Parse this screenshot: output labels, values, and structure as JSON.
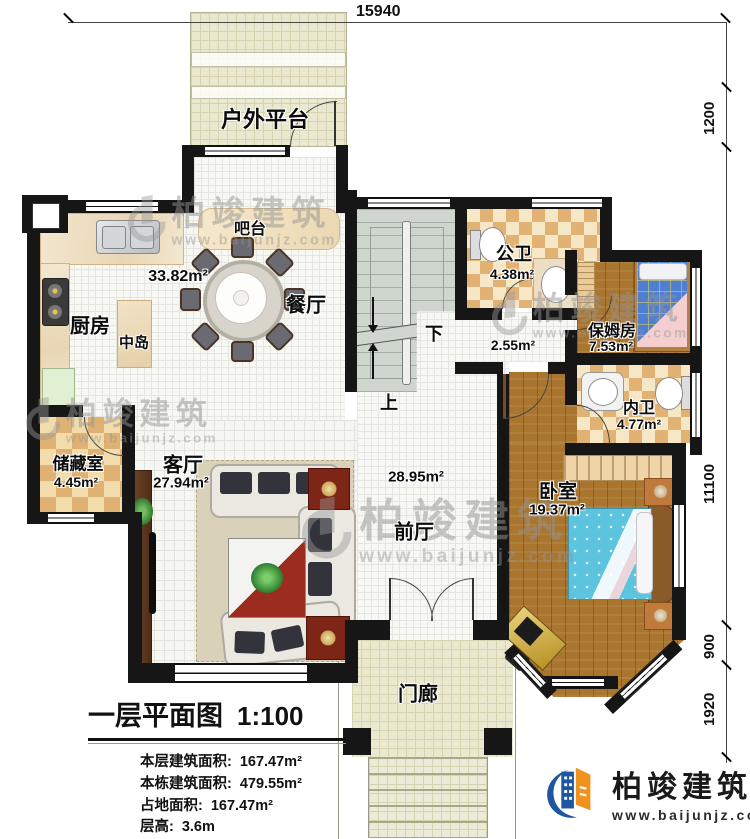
{
  "dimensions": {
    "top": "15940",
    "right": {
      "r1": "1200",
      "r2": "11100",
      "r3": "900",
      "r4": "1920"
    }
  },
  "rooms": {
    "platform": {
      "name": "户外平台"
    },
    "bar": {
      "name": "吧台"
    },
    "dining": {
      "name": "餐厅"
    },
    "dining_area": "33.82m²",
    "kitchen": {
      "name": "厨房"
    },
    "island": {
      "name": "中岛"
    },
    "public_bath": {
      "name": "公卫",
      "area": "4.38m²"
    },
    "nanny_room": {
      "name": "保姆房",
      "area": "7.53m²"
    },
    "inner_bath": {
      "name": "内卫",
      "area": "4.77m²"
    },
    "storage": {
      "name": "储藏室",
      "area": "4.45m²"
    },
    "living": {
      "name": "客厅",
      "area": "27.94m²"
    },
    "foyer": {
      "name": "前厅",
      "area": "28.95m²"
    },
    "corridor_area": "2.55m²",
    "bedroom": {
      "name": "卧室",
      "area": "19.37m²"
    },
    "porch": {
      "name": "门廊"
    }
  },
  "stairs": {
    "down": "下",
    "up": "上"
  },
  "title_block": {
    "title": "一层平面图",
    "scale": "1:100",
    "stats": [
      {
        "label": "本层建筑面积:",
        "value": "167.47m²"
      },
      {
        "label": "本栋建筑面积:",
        "value": "479.55m²"
      },
      {
        "label": "占地面积:",
        "value": "167.47m²"
      },
      {
        "label": "层高:",
        "value": "3.6m"
      }
    ]
  },
  "watermark": {
    "brand": "柏竣建筑",
    "url": "www.baijunjz.com"
  },
  "logo": {
    "brand": "柏竣建筑",
    "url": "www.baijunjz.com"
  },
  "colors": {
    "wall": "#161616",
    "wood": "#a9752f",
    "accent_blue": "#1e56a0",
    "accent_orange": "#f0921e",
    "bed_blue": "#5cc4de"
  }
}
